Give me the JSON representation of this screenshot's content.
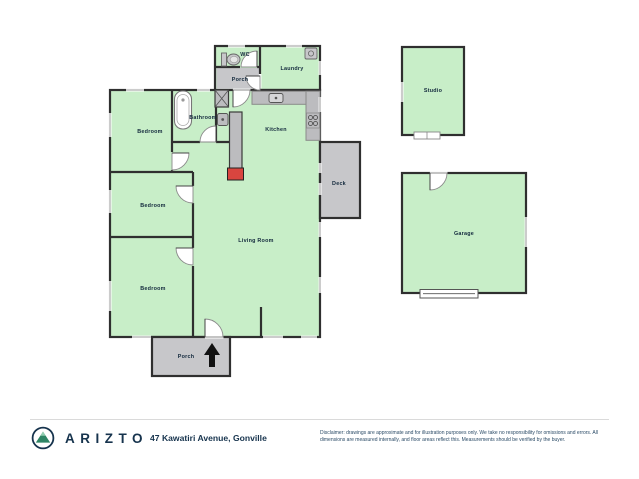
{
  "document_type": "floor-plan",
  "rooms": {
    "wc": {
      "label": "WC"
    },
    "porch_top": {
      "label": "Porch"
    },
    "laundry": {
      "label": "Laundry"
    },
    "bathroom": {
      "label": "Bathroom"
    },
    "kitchen": {
      "label": "Kitchen"
    },
    "bedroom_1": {
      "label": "Bedroom"
    },
    "bedroom_2": {
      "label": "Bedroom"
    },
    "bedroom_3": {
      "label": "Bedroom"
    },
    "living_room": {
      "label": "Living Room"
    },
    "deck": {
      "label": "Deck"
    },
    "porch_bottom": {
      "label": "Porch"
    },
    "studio": {
      "label": "Studio"
    },
    "garage": {
      "label": "Garage"
    }
  },
  "fixtures": {
    "toilet": "toilet",
    "bathtub": "bathtub",
    "shower": "shower",
    "bathroom_sink": "sink",
    "kitchen_sink": "sink",
    "stove": "stove-4-burner",
    "washing_machine": "washing-machine",
    "fireplace": "fireplace",
    "chimney": "chimney",
    "north_arrow": "north-arrow",
    "garage_door": "garage-door"
  },
  "footer": {
    "brand": "ARIZTO",
    "logo": "mountain-in-circle",
    "address": "47 Kawatiri Avenue, Gonville",
    "disclaimer": "Disclaimer: drawings are approximate and for illustration purposes only. We take no responsibility for omissions and errors. All dimensions are measured internally, and floor areas reflect this. Measurements should be verified by the buyer."
  },
  "colors": {
    "room_fill": "#c8eec8",
    "hard_surface_fill": "#c7c7ca",
    "counter_fill": "#bcbcbf",
    "wall": "#2f2f2f",
    "fireplace_red": "#d9453f",
    "brand_navy": "#16334d",
    "logo_green": "#2f8565"
  }
}
